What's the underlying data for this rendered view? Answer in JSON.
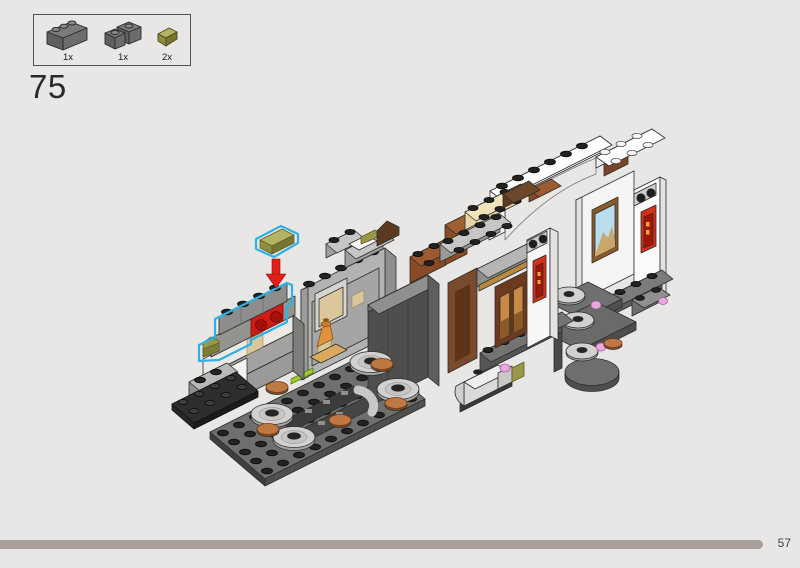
{
  "page": {
    "number": "57",
    "background": "#e8e7e5"
  },
  "step": {
    "number": "75"
  },
  "parts_box": {
    "parts": [
      {
        "qty": "1x",
        "name": "brick-1x3-dark-gray",
        "color": "#6d6e6c"
      },
      {
        "qty": "1x",
        "name": "facet-brick-2x2-dark-gray",
        "color": "#6d6e6c"
      },
      {
        "qty": "2x",
        "name": "slope-1x1-olive-green",
        "color": "#9a9848"
      }
    ]
  },
  "illustration": {
    "callout": {
      "piece": "olive-green-slope",
      "arrow_color": "#df1f1a",
      "highlight_color": "#2bb3e6"
    },
    "accent_colors": {
      "red_brick": "#cf1d15",
      "red_scroll": "#d23018",
      "olive": "#9a9848",
      "tan": "#d8c79b",
      "brown": "#8a4a26",
      "white": "#f6f5f3",
      "lime": "#9ccd2a",
      "pink": "#eaa8de",
      "copper": "#bd7843",
      "gray": "#9a9a98",
      "dark_gray": "#4e4e4c"
    }
  },
  "footer": {
    "bar_color": "#a9a09b"
  }
}
